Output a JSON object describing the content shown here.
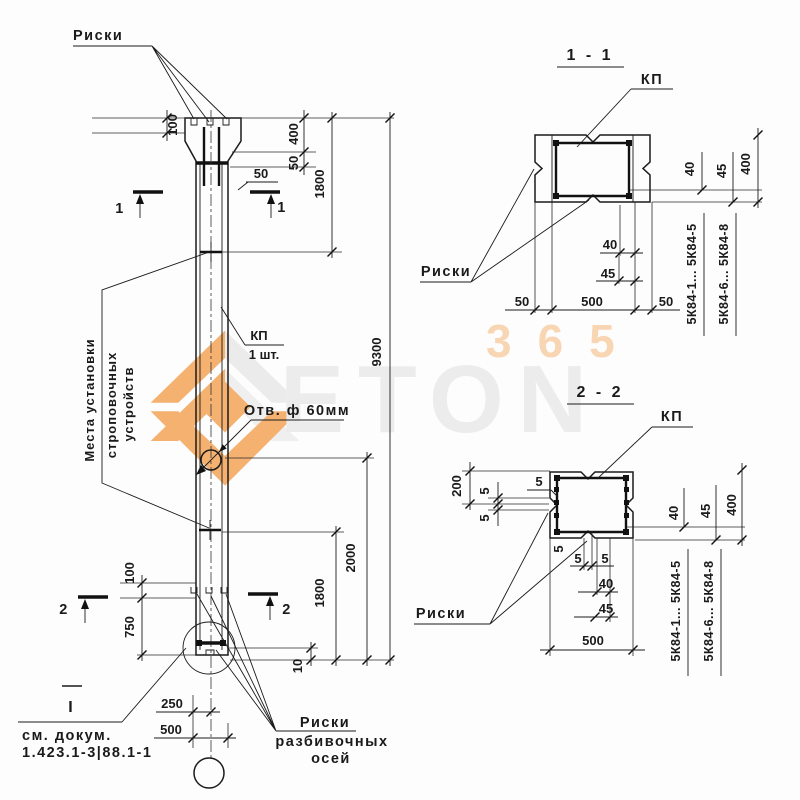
{
  "watermark": {
    "brand": "ETON",
    "number": "365",
    "orange": "#f3a458",
    "gray": "#e8e8e8"
  },
  "elevation": {
    "riski_top": "Риски",
    "strop_line1": "Места установки",
    "strop_line2": "строповочных",
    "strop_line3": "устройств",
    "kp_label": "КП",
    "kp_qty": "1 шт.",
    "hole_label": "Отв. ф 60мм",
    "axes_line1": "Риски",
    "axes_line2": "разбивочных",
    "axes_line3": "осей",
    "doc_line1": "см. докум.",
    "doc_line2": "1.423.1-3|88.1-1",
    "datum_mark": "I",
    "dims": {
      "top100": "100",
      "head400": "400",
      "head50": "50",
      "shaft50": "50",
      "upper1800": "1800",
      "total9300": "9300",
      "hole2000": "2000",
      "lower1800": "1800",
      "low100": "100",
      "low750": "750",
      "gap10": "10",
      "axis250": "250",
      "axis500": "500"
    },
    "marks": {
      "sec1": "1",
      "sec2": "2"
    }
  },
  "section1": {
    "title": "1 - 1",
    "kp": "КП",
    "riski": "Риски",
    "dims": {
      "r40": "40",
      "r45": "45",
      "r400": "400",
      "s40": "40",
      "s45": "45",
      "b50l": "50",
      "b500": "500",
      "b50r": "50"
    },
    "series1": "5К84-1... 5К84-5",
    "series2": "5К84-6... 5К84-8"
  },
  "section2": {
    "title": "2 - 2",
    "kp": "КП",
    "riski": "Риски",
    "dims": {
      "l200": "200",
      "l5a": "5",
      "l5b": "5",
      "c5": "5",
      "bs5": "5",
      "b5a": "5",
      "b5b": "5",
      "r40": "40",
      "r45": "45",
      "r400": "400",
      "s40": "40",
      "s45": "45",
      "b500": "500"
    },
    "series1": "5К84-1... 5К84-5",
    "series2": "5К84-6... 5К84-8"
  }
}
